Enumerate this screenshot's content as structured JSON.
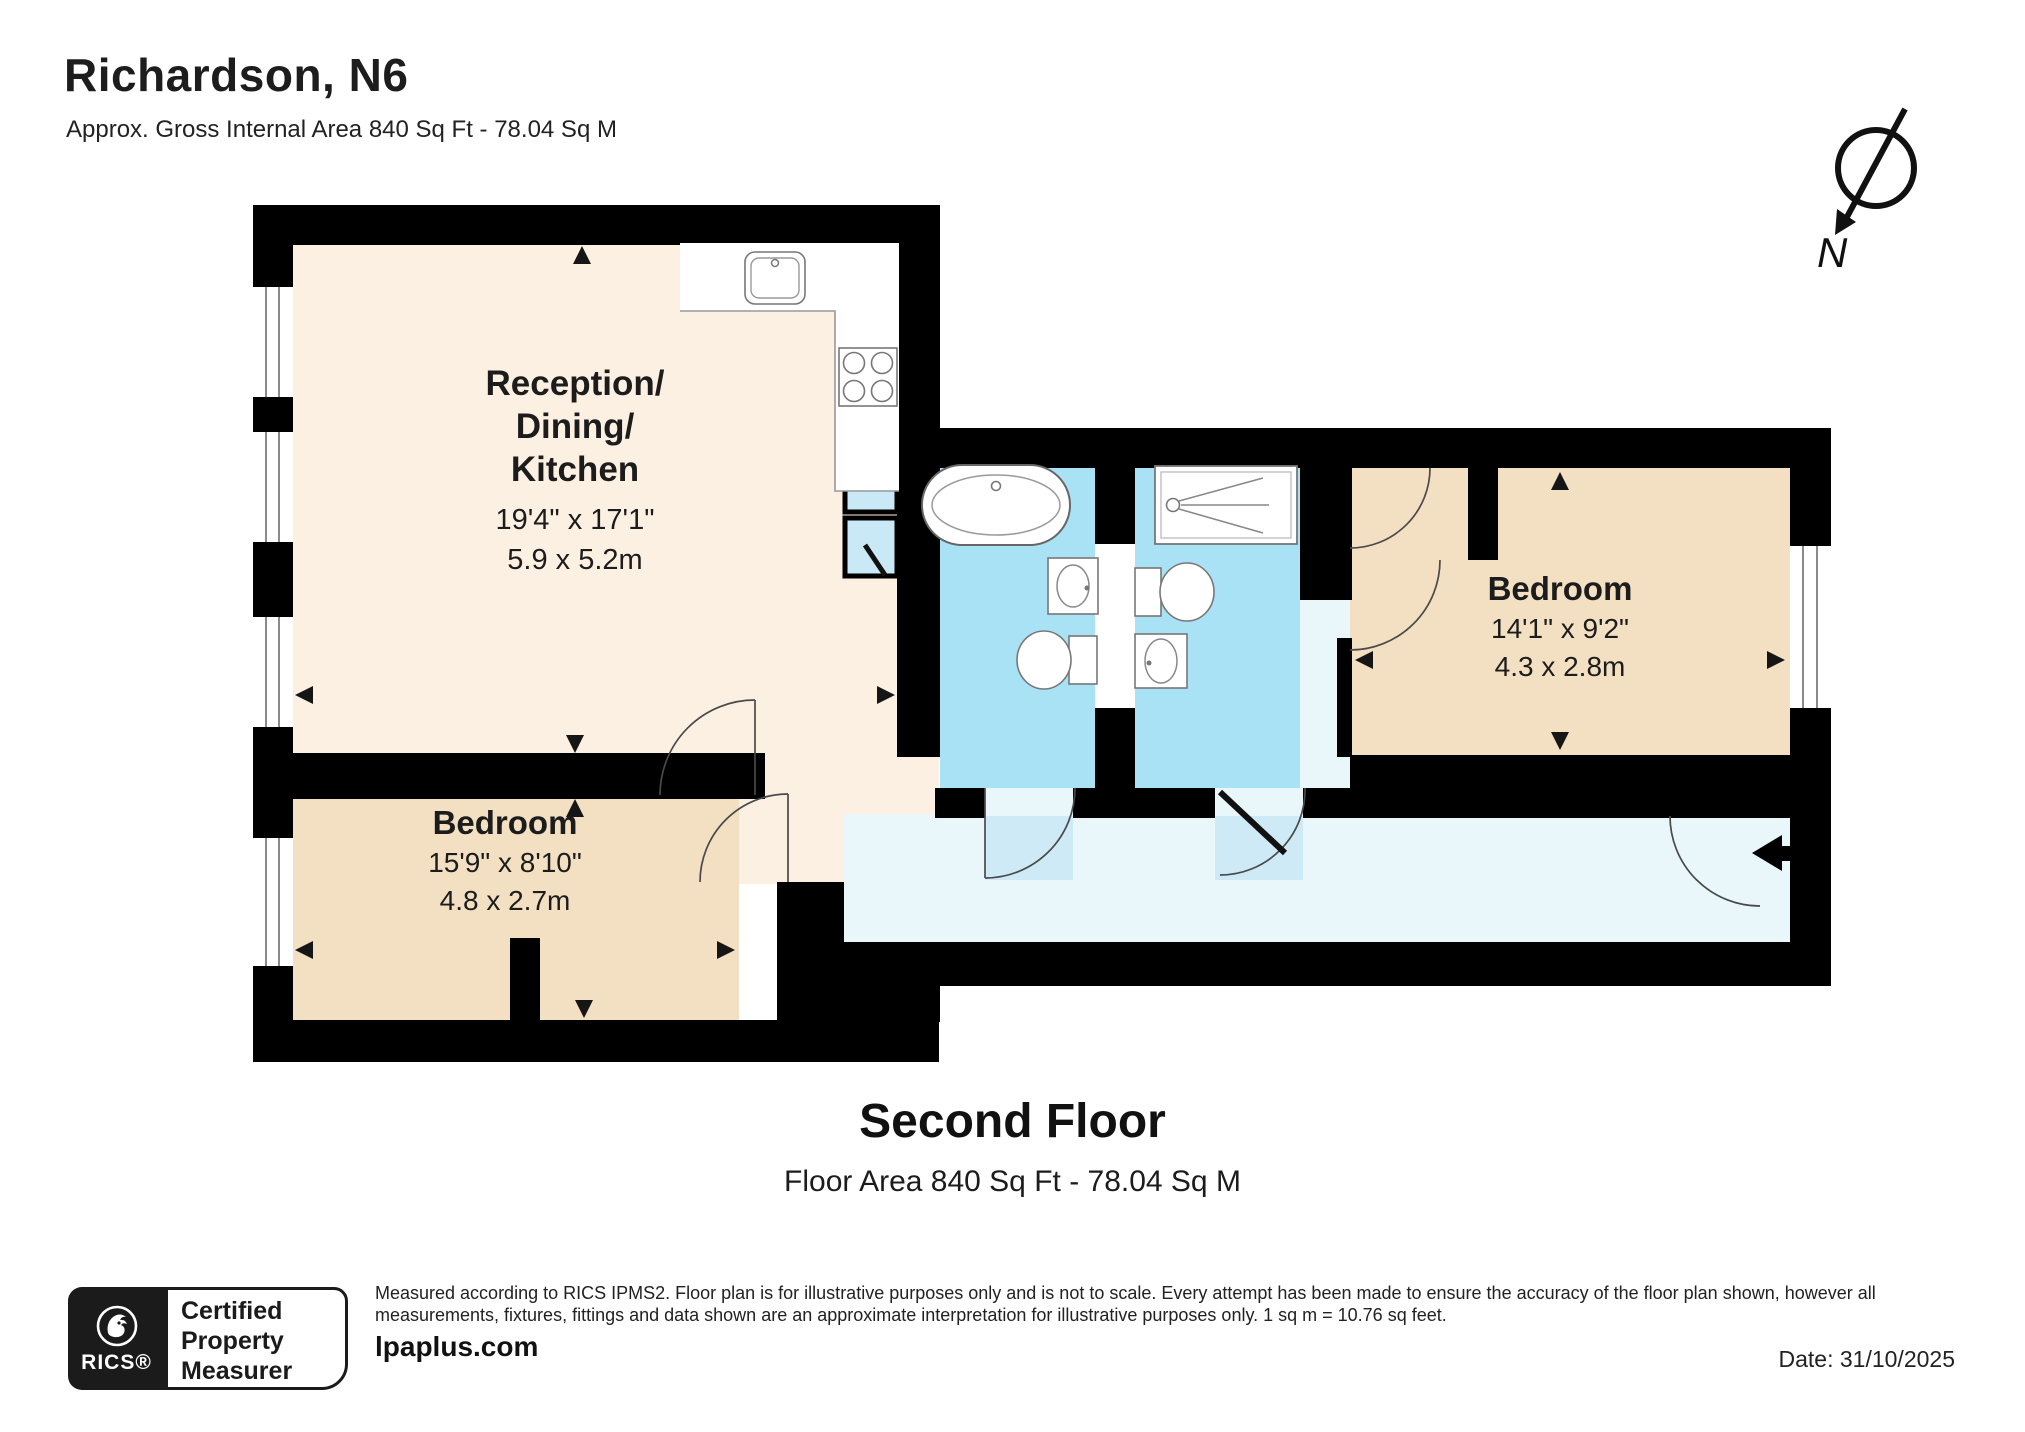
{
  "header": {
    "title": "Richardson, N6",
    "subtitle": "Approx. Gross Internal Area 840 Sq Ft - 78.04 Sq M"
  },
  "compass": {
    "north_label": "N"
  },
  "plan": {
    "rooms": [
      {
        "id": "reception-dining-kitchen",
        "name_lines": [
          "Reception/",
          "Dining/",
          "Kitchen"
        ],
        "dims_imperial": "19'4\" x 17'1\"",
        "dims_metric": "5.9 x 5.2m"
      },
      {
        "id": "bedroom-1",
        "name_lines": [
          "Bedroom"
        ],
        "dims_imperial": "15'9\" x 8'10\"",
        "dims_metric": "4.8 x 2.7m"
      },
      {
        "id": "bedroom-2",
        "name_lines": [
          "Bedroom"
        ],
        "dims_imperial": "14'1\" x 9'2\"",
        "dims_metric": "4.3 x 2.8m"
      }
    ],
    "colors": {
      "wall": "#000000",
      "reception_floor": "#fcf0e2",
      "bedroom_floor": "#f3dfc2",
      "bathroom_floor": "#a9e1f5",
      "hallway_floor": "#e9f7fb",
      "closet_fill": "#c9e9f6"
    }
  },
  "floor_label": {
    "title": "Second Floor",
    "subtitle": "Floor Area 840 Sq Ft - 78.04 Sq M"
  },
  "footer": {
    "rics_badge": {
      "brand": "RICS®",
      "lines": [
        "Certified",
        "Property",
        "Measurer"
      ]
    },
    "disclaimer": "Measured according to RICS IPMS2. Floor plan is for illustrative purposes only and is not to scale. Every attempt has been made to ensure the accuracy of the floor plan shown, however all measurements, fixtures, fittings and data shown are an approximate interpretation for illustrative purposes only. 1 sq m = 10.76 sq feet.",
    "website": "lpaplus.com",
    "date": "Date: 31/10/2025"
  }
}
